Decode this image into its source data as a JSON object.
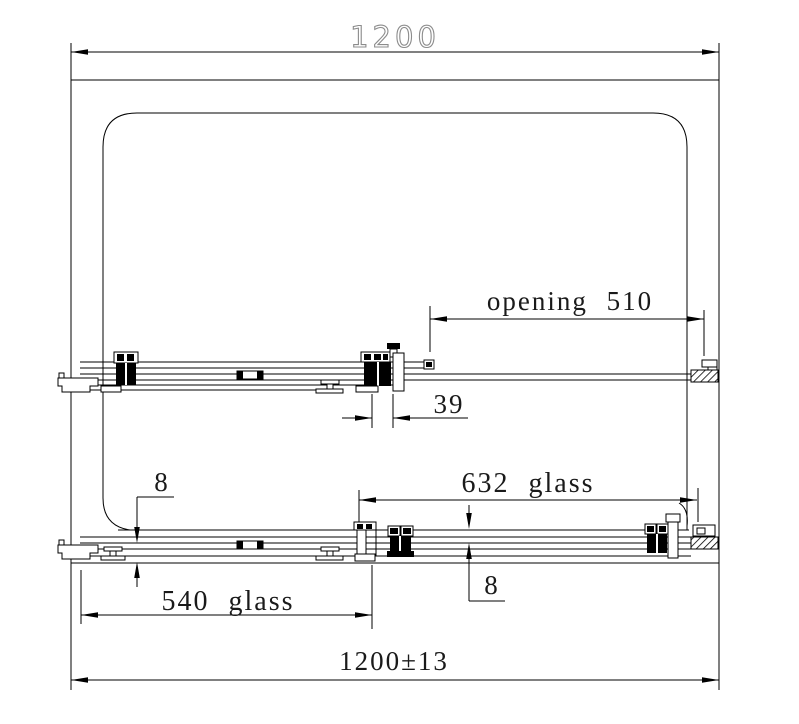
{
  "drawing": {
    "type": "technical-diagram",
    "subject": "sliding shower screen plan-section drawing with dimensions",
    "background_color": "#ffffff",
    "line_color": "#000000",
    "label_color": "#1a1a1a",
    "top_label_color": "#8c8c8c",
    "labels": {
      "overall_width_top": "1200",
      "opening_width": "opening 510",
      "panel_overlap": "39",
      "fixed_panel_glass": "632 glass",
      "glass_thickness_left": "8",
      "door_panel_glass": "540 glass",
      "glass_thickness_right": "8",
      "overall_width_tolerance": "1200±13"
    }
  }
}
